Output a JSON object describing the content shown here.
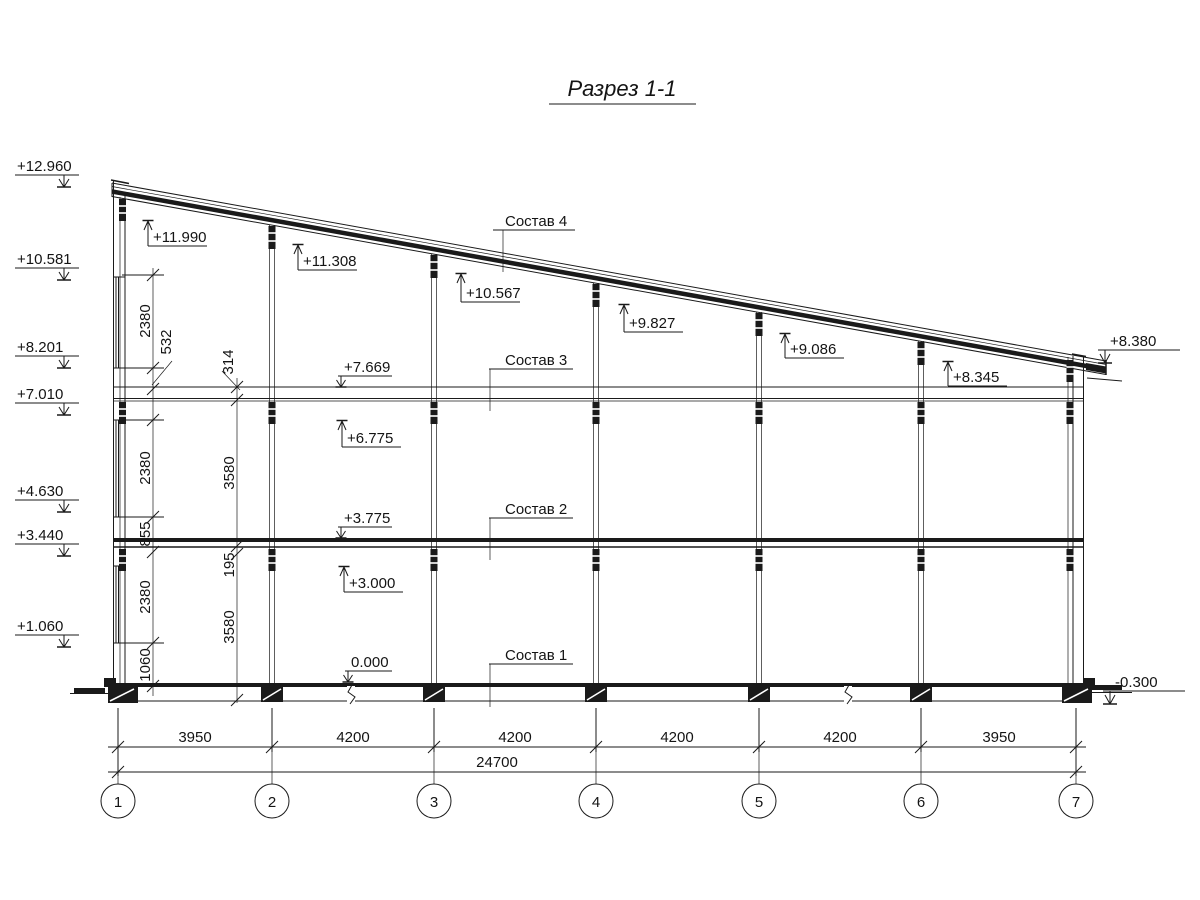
{
  "title": "Разрез 1-1",
  "elevations_left": {
    "v12960": "+12.960",
    "v10581": "+10.581",
    "v8201": "+8.201",
    "v7010": "+7.010",
    "v4630": "+4.630",
    "v3440": "+3.440",
    "v1060": "+1.060"
  },
  "elevations_right": {
    "v8380": "+8.380",
    "vm0300": "-0.300"
  },
  "elevations_interior": {
    "v11990": "+11.990",
    "v11308": "+11.308",
    "v10567": "+10.567",
    "v9827": "+9.827",
    "v9086": "+9.086",
    "v8345": "+8.345",
    "v7669": "+7.669",
    "v6775": "+6.775",
    "v3775": "+3.775",
    "v3000": "+3.000",
    "v0000": "0.000"
  },
  "compositions": {
    "c4": "Состав 4",
    "c3": "Состав 3",
    "c2": "Состав 2",
    "c1": "Состав 1"
  },
  "vertical_dimensions": {
    "chain_a": [
      "2380",
      "532",
      "2380",
      "855",
      "2380",
      "1060"
    ],
    "chain_b": [
      "314",
      "3580",
      "195",
      "3580"
    ]
  },
  "horizontal_dimensions": {
    "spans": [
      "3950",
      "4200",
      "4200",
      "4200",
      "4200",
      "3950"
    ],
    "total": "24700"
  },
  "grid_axes": [
    "1",
    "2",
    "3",
    "4",
    "5",
    "6",
    "7"
  ]
}
